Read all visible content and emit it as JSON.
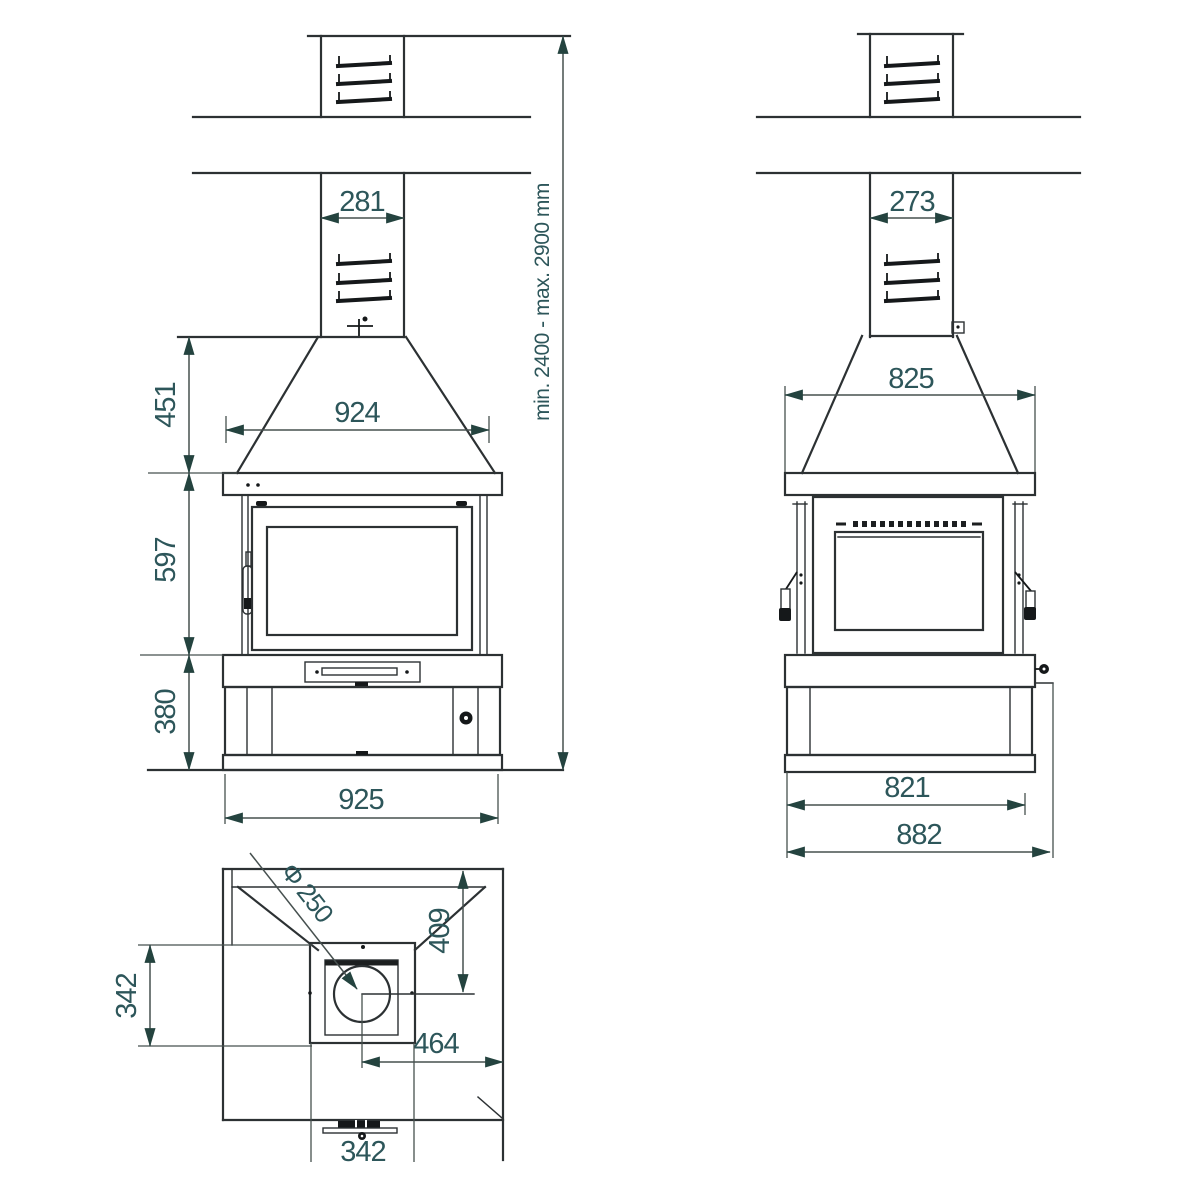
{
  "drawing_type": "fireplace-dimension-drawing",
  "colors": {
    "line": "#2c3133",
    "dim_text": "#2d565a",
    "arrow": "#24433f"
  },
  "front_view": {
    "chimney_width": "281",
    "hood_height": "451",
    "hood_width": "924",
    "firebox_height": "597",
    "base_height": "380",
    "overall_width": "925",
    "install_height_range": "min. 2400 - max. 2900 mm"
  },
  "side_view": {
    "chimney_depth": "273",
    "hood_depth": "825",
    "base_depth": "821",
    "overall_depth": "882"
  },
  "top_view": {
    "flue_diameter": "Φ 250",
    "flue_center_from_back": "409",
    "opening_depth": "342",
    "flue_center_to_side": "464",
    "collar_width": "342"
  }
}
